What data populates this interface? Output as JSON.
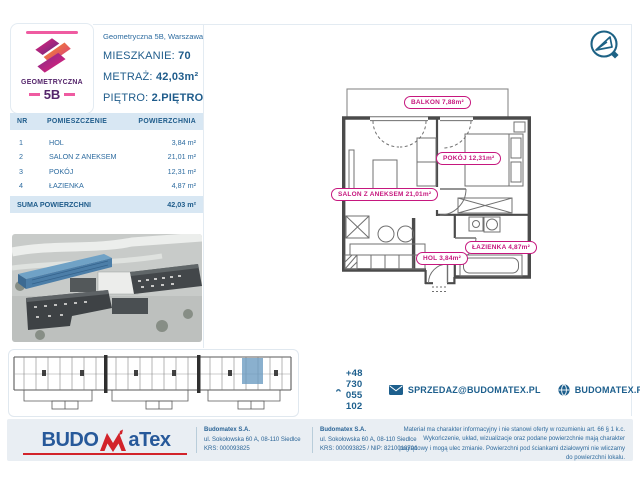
{
  "logo": {
    "brand_line1": "GEOMETRYCZNA",
    "brand_line2": "5B"
  },
  "header": {
    "address": "Geometryczna 5B, Warszawa",
    "unit_label": "MIESZKANIE:",
    "unit_value": "70",
    "area_label": "METRAŻ:",
    "area_value": "42,03m²",
    "floor_label": "PIĘTRO:",
    "floor_value": "2.PIĘTRO"
  },
  "table": {
    "col_nr": "NR",
    "col_room": "POMIESZCZENIE",
    "col_area": "POWIERZCHNIA",
    "rows": [
      {
        "nr": "1",
        "room": "HOL",
        "area": "3,84 m²"
      },
      {
        "nr": "2",
        "room": "SALON Z ANEKSEM",
        "area": "21,01 m²"
      },
      {
        "nr": "3",
        "room": "POKÓJ",
        "area": "12,31 m²"
      },
      {
        "nr": "4",
        "room": "ŁAZIENKA",
        "area": "4,87 m²"
      }
    ],
    "total_label": "SUMA POWIERZCHNI",
    "total_area": "42,03 m²"
  },
  "plan_labels": {
    "balkon": "BALKON 7,88m²",
    "pokoj": "POKÓJ 12,31m²",
    "salon": "SALON Z ANEKSEM 21,01m²",
    "lazienka": "ŁAZIENKA 4,87m²",
    "hol": "HOL 3,84m²"
  },
  "contact": {
    "phone": "+48 730 055 102",
    "email": "SPRZEDAZ@BUDOMATEX.PL",
    "website": "BUDOMATEX.PL"
  },
  "footer": {
    "brand_prefix": "BUDO",
    "brand_suffix": "aTex",
    "company_1": {
      "name": "Budomatex S.A.",
      "address": "ul. Sokołowska 60 A, 08-110 Siedlce",
      "registry": "KRS: 000093825"
    },
    "company_2": {
      "name": "Budomatex S.A.",
      "address": "ul. Sokołowska 60 A, 08-110 Siedlce",
      "registry": "KRS: 000093825 / NIP: 8210010701"
    },
    "disclaimer": "Materiał ma charakter informacyjny i nie stanowi oferty w rozumieniu art. 66 § 1 k.c. Wykończenie, układ, wizualizacje oraz podane powierzchnie mają charakter poglądowy i mogą ulec zmianie. Powierzchni pod ściankami działowymi nie wliczamy do powierzchni lokalu."
  },
  "icons": {
    "compass": "north-arrow-in-circle",
    "phone": "handset",
    "email": "envelope",
    "website": "globe"
  },
  "colors": {
    "accent_magenta": "#c6177e",
    "primary_blue": "#1f5c8b",
    "table_band": "#d8e7f3",
    "highlight_blue": "#5d8fb5",
    "logo_red": "#d2232a",
    "logo_blue": "#27599a"
  }
}
